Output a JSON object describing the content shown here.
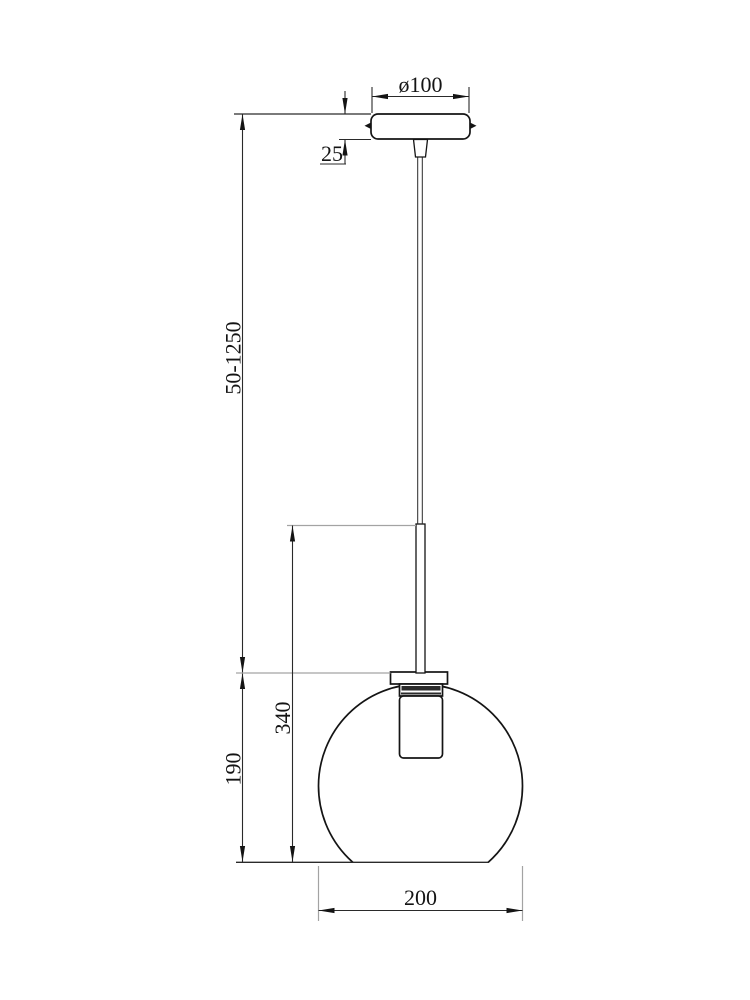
{
  "drawing": {
    "type": "pendant-lamp-dimension-drawing",
    "dimensions": {
      "canopy_diameter": {
        "label": "ø100"
      },
      "canopy_height": {
        "label": "25"
      },
      "suspension_range": {
        "label": "50-1250"
      },
      "body_height": {
        "label": "340"
      },
      "shade_height": {
        "label": "190"
      },
      "shade_width": {
        "label": "200"
      }
    },
    "colors": {
      "object_line": "#141414",
      "dimension_line": "#2a2a2a",
      "extension_line": "#a3a3a3",
      "background": "#ffffff"
    }
  }
}
